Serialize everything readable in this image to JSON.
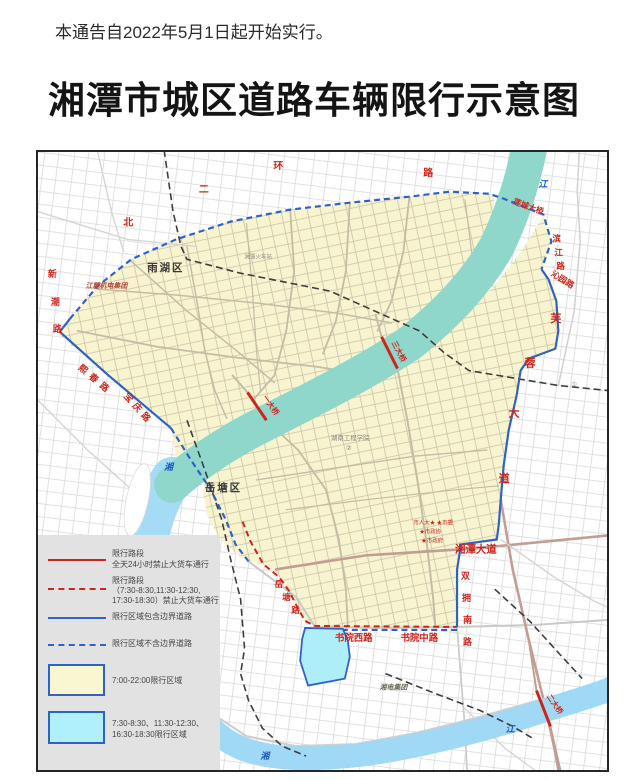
{
  "notice": "本通告自2022年5月1日起开始实行。",
  "title": "湘潭市城区道路车辆限行示意图",
  "colors": {
    "restricted_red": "#cf241a",
    "boundary_blue": "#2f62c5",
    "zone_yellow": "#f8f4d0",
    "zone_cyan": "#adeef8",
    "river_teal": "#8fd7cb",
    "river_blue": "#a5dbf4"
  },
  "map": {
    "districts": {
      "yuhu": "雨湖区",
      "yuetang": "岳塘区"
    },
    "roads": {
      "north_ring": [
        "北",
        "二",
        "环",
        "路"
      ],
      "xinchao": [
        "新",
        "潮",
        "路"
      ],
      "xichun": "熙春路",
      "baoqing": "宝庆路",
      "binjiang": [
        "滨",
        "江",
        "路"
      ],
      "qinyuan": "沁园路",
      "furong": [
        "芙",
        "蓉",
        "大",
        "道"
      ],
      "xiangtan_avenue": "湘潭大道",
      "shuangyong": [
        "双",
        "拥",
        "南",
        "路"
      ],
      "shuyuan_west": "书院西路",
      "shuyuan_mid": "书院中路",
      "yuetang_road": [
        "岳",
        "塘",
        "路"
      ]
    },
    "bridges": {
      "liancheng": "莲城大桥",
      "yidaqiao": "一大桥",
      "sandaqiao": "三大桥",
      "erdaqiao": "二大桥"
    },
    "rivers": {
      "jiang_top": "江",
      "xiang_mid": "湘",
      "xiang_bottom": "湘",
      "jiang_bottom": "江"
    },
    "places": {
      "jianglu": "江麓机电集团",
      "station": "湘潭火车站",
      "hunan_institute": "湖南工程学院",
      "xiangdian": "湘电集团",
      "gov_line1": "市人大★ ★市委",
      "gov_line2": "★市政协",
      "gov_line3": "★市政府",
      "circle1": "①",
      "circle2": "②"
    }
  },
  "legend": {
    "items": [
      {
        "line1": "限行路段",
        "line2": "全天24小时禁止大货车通行"
      },
      {
        "line1": "限行路段",
        "line2": "（7:30-8:30,11:30-12:30,",
        "line3": "17:30-18:30）禁止大货车通行"
      },
      {
        "line1": "限行区域包含边界道路"
      },
      {
        "line1": "限行区域不含边界道路"
      },
      {
        "line1": "7:00-22:00限行区域"
      },
      {
        "line1": "7:30-8:30、11:30-12:30、",
        "line2": "16:30-18:30限行区域"
      }
    ]
  }
}
